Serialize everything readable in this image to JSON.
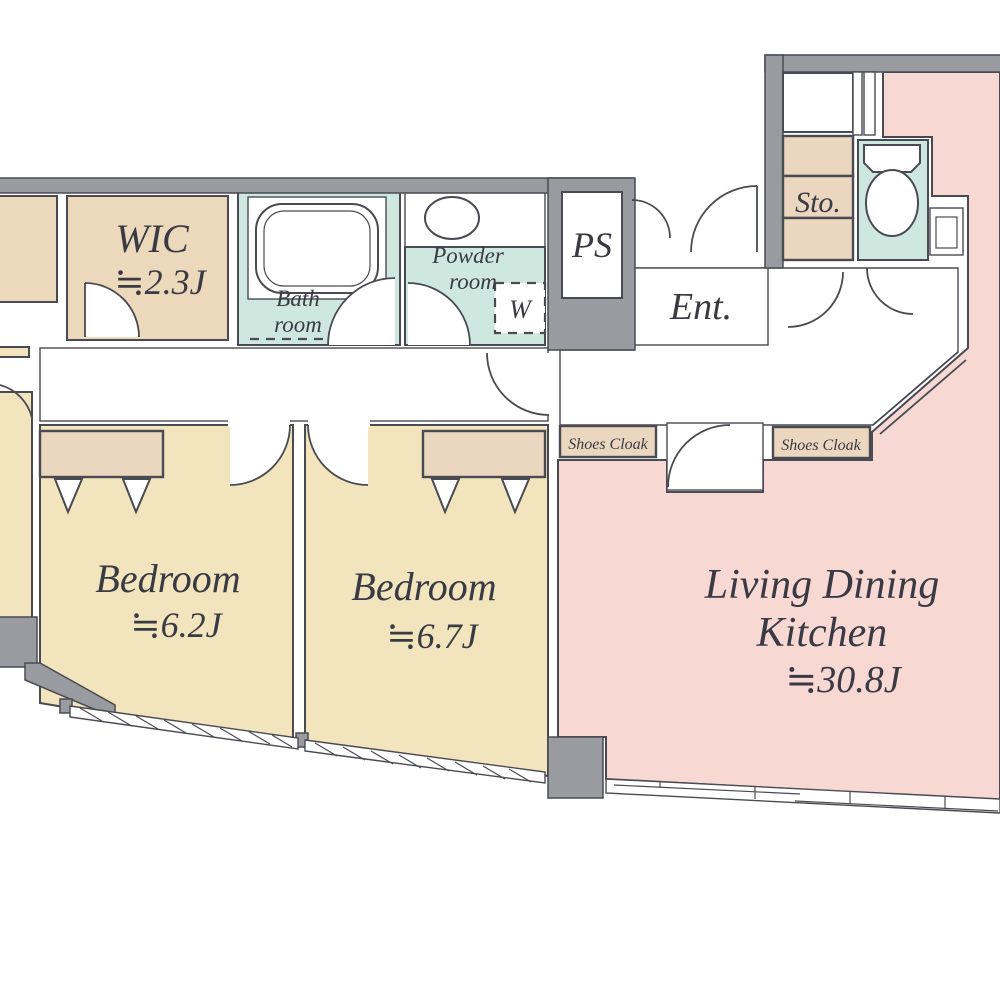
{
  "colors": {
    "wall": "#9a9aa1",
    "line": "#4a4a52",
    "text": "#3a3a44",
    "tan": "#ecd8ba",
    "beige": "#ebd6c0",
    "cream": "#f2e4bd",
    "mint": "#cfe8df",
    "pink": "#f7d8d3"
  },
  "rooms": {
    "wic": {
      "name": "WIC",
      "area": "≒2.3J"
    },
    "bath": {
      "line1": "Bath",
      "line2": "room"
    },
    "powder": {
      "line1": "Powder",
      "line2": "room"
    },
    "washer": {
      "label": "W"
    },
    "ps": {
      "label": "PS"
    },
    "ent": {
      "label": "Ent."
    },
    "sto": {
      "label": "Sto."
    },
    "shoes_cloak_left": {
      "label": "Shoes Cloak"
    },
    "shoes_cloak_right": {
      "label": "Shoes Cloak"
    },
    "bedroom_left": {
      "name": "Bedroom",
      "area": "≒6.2J"
    },
    "bedroom_right": {
      "name": "Bedroom",
      "area": "≒6.7J"
    },
    "ldk": {
      "line1": "Living Dining",
      "line2": "Kitchen",
      "area": "≒30.8J"
    }
  }
}
